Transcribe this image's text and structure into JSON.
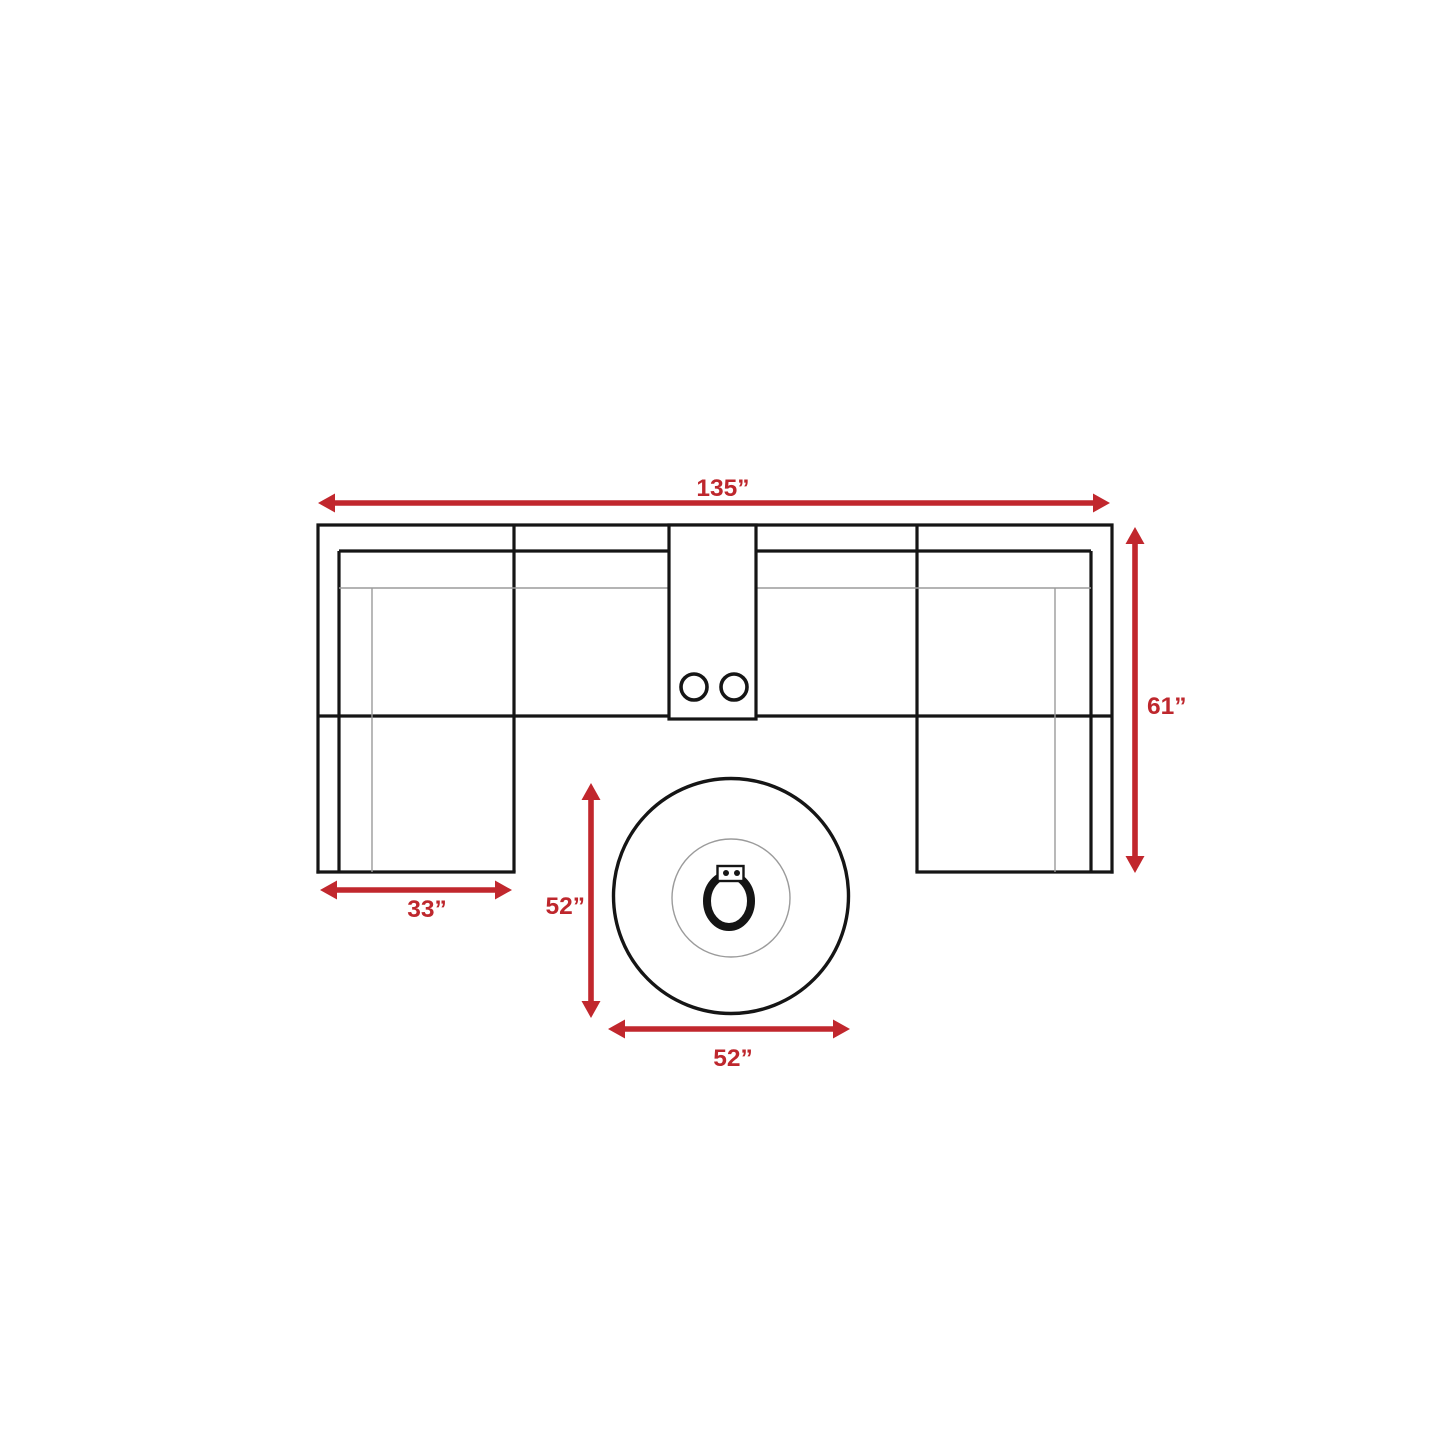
{
  "colors": {
    "arrow_red": "#C1272D",
    "label_red": "#BE272D",
    "outline_black": "#151515",
    "detail_gray": "#9b9b9b",
    "background": "#FFFFFF"
  },
  "diagram": {
    "labels": {
      "sofa_width": "135”",
      "sofa_depth": "61”",
      "chaise_width": "33”",
      "table_depth": "52”",
      "table_width": "52”"
    }
  }
}
